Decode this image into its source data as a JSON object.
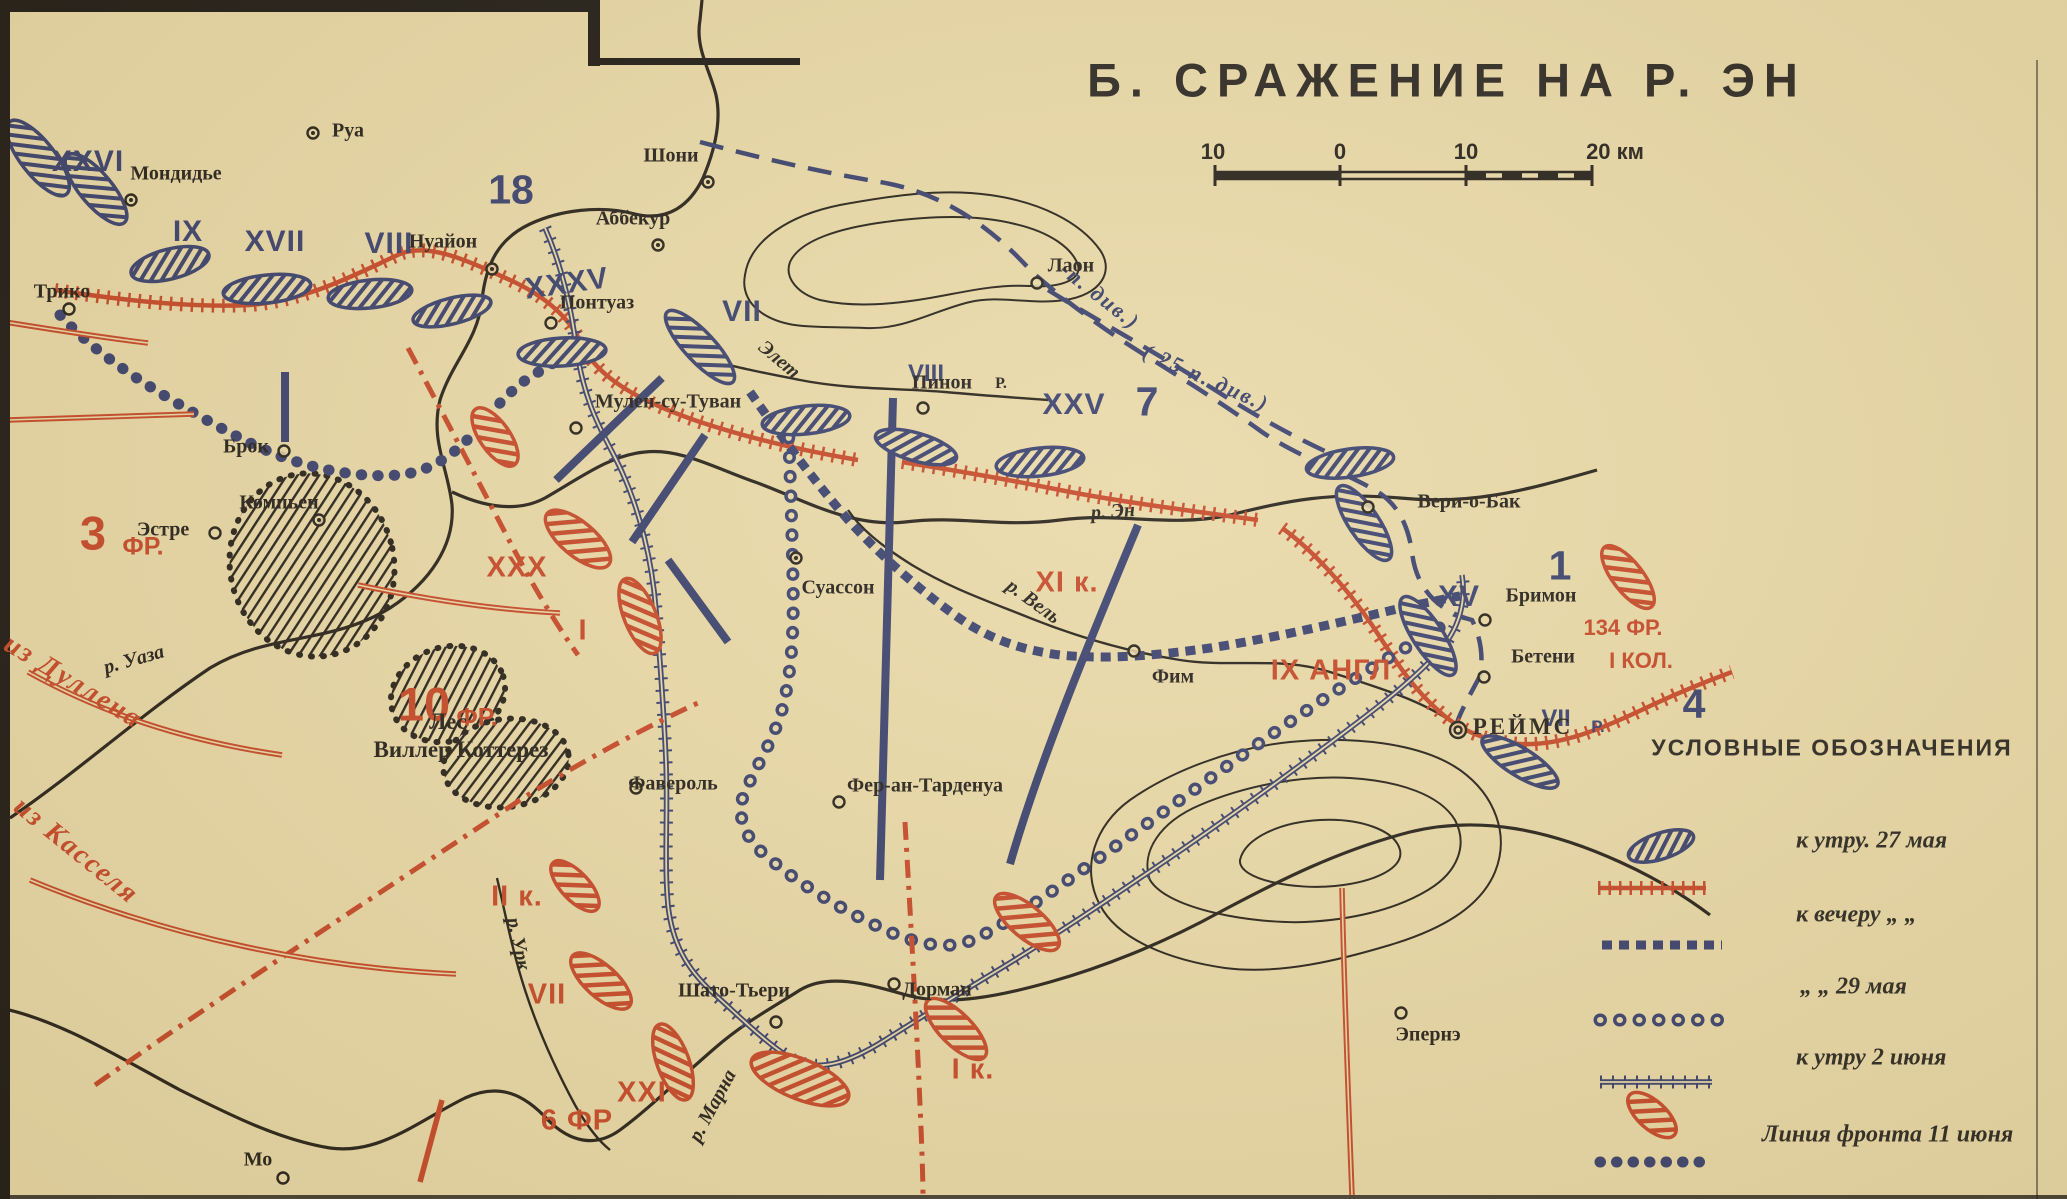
{
  "title": "Б. СРАЖЕНИЕ НА Р. ЭН",
  "colors": {
    "paper": "#e9d9a8",
    "blue": "#39406d",
    "red": "#c64828",
    "black": "#25201a"
  },
  "scale_bar": {
    "unit_note": "км",
    "tick_labels": [
      {
        "text": "10",
        "x": 1213
      },
      {
        "text": "0",
        "x": 1340
      },
      {
        "text": "10",
        "x": 1466
      },
      {
        "text": "20 км",
        "x": 1615
      }
    ]
  },
  "legend": {
    "number": "4",
    "title": "УСЛОВНЫЕ ОБОЗНАЧЕНИЯ",
    "items": [
      {
        "symbol": "blue-hatched-oval-icon",
        "label": "к утру. 27 мая",
        "x": 1796,
        "y": 841
      },
      {
        "symbol": "red-hatched-frontline-icon",
        "label": "к вечеру  „   „",
        "x": 1796,
        "y": 915
      },
      {
        "symbol": "blue-sawtooth-line-icon",
        "label": "„     „    29 мая",
        "x": 1800,
        "y": 987
      },
      {
        "symbol": "blue-circle-chain-icon",
        "label": "к утру 2 июня",
        "x": 1796,
        "y": 1058
      },
      {
        "symbol": "blue-double-tick-line-red-oval-teardrop-icon",
        "label": "Линия фронта 11 июня",
        "x": 1762,
        "y": 1135
      }
    ]
  },
  "towns": [
    {
      "name": "Руа",
      "x": 348,
      "y": 131,
      "cx": 313,
      "cy": 133,
      "t": "d"
    },
    {
      "name": "Мондидье",
      "x": 176,
      "y": 174,
      "cx": 131,
      "cy": 200,
      "t": "d"
    },
    {
      "name": "Трико",
      "x": 62,
      "y": 292,
      "cx": 69,
      "cy": 309,
      "t": "p"
    },
    {
      "name": "Нуайон",
      "x": 443,
      "y": 242,
      "cx": 492,
      "cy": 269,
      "t": "d"
    },
    {
      "name": "Шони",
      "x": 671,
      "y": 156,
      "cx": 708,
      "cy": 182,
      "t": "d"
    },
    {
      "name": "Аббекур",
      "x": 633,
      "y": 219,
      "cx": 658,
      "cy": 245,
      "t": "d"
    },
    {
      "name": "Понтуаз",
      "x": 597,
      "y": 303,
      "cx": 551,
      "cy": 323,
      "t": "p"
    },
    {
      "name": "Лаон",
      "x": 1071,
      "y": 266,
      "cx": 1037,
      "cy": 283,
      "t": "p"
    },
    {
      "name": "Мулен-су-Туван",
      "x": 668,
      "y": 402,
      "cx": 576,
      "cy": 428,
      "t": "p"
    },
    {
      "name": "Брок",
      "x": 246,
      "y": 447,
      "cx": 284,
      "cy": 451,
      "t": "p"
    },
    {
      "name": "Компьен",
      "x": 279,
      "y": 503,
      "cx": 319,
      "cy": 520,
      "t": "d"
    },
    {
      "name": "Эстре",
      "x": 163,
      "y": 530,
      "cx": 215,
      "cy": 533,
      "t": "p"
    },
    {
      "name": "Суассон",
      "x": 838,
      "y": 588,
      "cx": 796,
      "cy": 558,
      "t": "d"
    },
    {
      "name": "Пинон",
      "x": 942,
      "y": 383,
      "cx": 923,
      "cy": 408,
      "t": "p"
    },
    {
      "name": "Фавероль",
      "x": 673,
      "y": 784,
      "cx": 636,
      "cy": 788,
      "t": "p"
    },
    {
      "name": "Фер-ан-Тарденуа",
      "x": 925,
      "y": 786,
      "cx": 839,
      "cy": 802,
      "t": "p"
    },
    {
      "name": "Шато-Тьери",
      "x": 734,
      "y": 991,
      "cx": 776,
      "cy": 1022,
      "t": "p"
    },
    {
      "name": "Дорман",
      "x": 937,
      "y": 990,
      "cx": 894,
      "cy": 984,
      "t": "p"
    },
    {
      "name": "Мо",
      "x": 258,
      "y": 1160,
      "cx": 283,
      "cy": 1178,
      "t": "p"
    },
    {
      "name": "Эпернэ",
      "x": 1428,
      "y": 1035,
      "cx": 1401,
      "cy": 1013,
      "t": "p"
    },
    {
      "name": "Вери-о-Бак",
      "x": 1469,
      "y": 502,
      "cx": 1368,
      "cy": 507,
      "t": "p"
    },
    {
      "name": "Бримон",
      "x": 1541,
      "y": 596,
      "cx": 1485,
      "cy": 620,
      "t": "p"
    },
    {
      "name": "Бетени",
      "x": 1543,
      "y": 657,
      "cx": 1484,
      "cy": 677,
      "t": "p"
    },
    {
      "name": "РЕЙМС",
      "x": 1523,
      "y": 727,
      "cx": 1458,
      "cy": 730,
      "t": "D"
    },
    {
      "name": "Фим",
      "x": 1173,
      "y": 677,
      "cx": 1134,
      "cy": 651,
      "t": "p"
    }
  ],
  "labels": [
    {
      "t": "18",
      "x": 511,
      "y": 190,
      "s": "barmy"
    },
    {
      "t": "7",
      "x": 1147,
      "y": 402,
      "s": "barmy"
    },
    {
      "t": "1",
      "x": 1560,
      "y": 566,
      "s": "barmy"
    },
    {
      "t": "4",
      "x": 1694,
      "y": 704,
      "s": "barmy"
    },
    {
      "t": "XXVI",
      "x": 88,
      "y": 162,
      "s": "bcorps"
    },
    {
      "t": "IX",
      "x": 188,
      "y": 232,
      "s": "bcorps"
    },
    {
      "t": "XVII",
      "x": 275,
      "y": 242,
      "s": "bcorps"
    },
    {
      "t": "VIII",
      "x": 389,
      "y": 244,
      "s": "bcorps"
    },
    {
      "t": "XXXV",
      "x": 567,
      "y": 284,
      "s": "bcorps",
      "r": -8
    },
    {
      "t": "VII",
      "x": 742,
      "y": 312,
      "s": "bcorps"
    },
    {
      "t": "VIII",
      "x": 926,
      "y": 374,
      "s": "bcorps2"
    },
    {
      "t": "XXV",
      "x": 1074,
      "y": 405,
      "s": "bcorps"
    },
    {
      "t": "XV",
      "x": 1459,
      "y": 597,
      "s": "bcorps"
    },
    {
      "t": "VII",
      "x": 1556,
      "y": 719,
      "s": "bcorps2"
    },
    {
      "t": "Р.",
      "x": 1598,
      "y": 727,
      "s": "btiny"
    },
    {
      "t": "Р.",
      "x": 1001,
      "y": 384,
      "s": "ktiny"
    },
    {
      "t": "-п. див.)",
      "x": 1100,
      "y": 296,
      "s": "bnote",
      "r": 38
    },
    {
      "t": "( 25 п. див.)",
      "x": 1206,
      "y": 378,
      "s": "bnote",
      "r": 24
    },
    {
      "t": "3",
      "x": 93,
      "y": 533,
      "s": "rbig"
    },
    {
      "t": "ФР.",
      "x": 143,
      "y": 547,
      "s": "rsm"
    },
    {
      "t": "10",
      "x": 424,
      "y": 704,
      "s": "rbig"
    },
    {
      "t": "ФР.",
      "x": 477,
      "y": 718,
      "s": "rsm"
    },
    {
      "t": "XXX",
      "x": 517,
      "y": 568,
      "s": "rcorps"
    },
    {
      "t": "I",
      "x": 583,
      "y": 631,
      "s": "rcorps"
    },
    {
      "t": "II к.",
      "x": 517,
      "y": 897,
      "s": "rcorps"
    },
    {
      "t": "VII",
      "x": 547,
      "y": 995,
      "s": "rcorps"
    },
    {
      "t": "XXI",
      "x": 642,
      "y": 1093,
      "s": "rcorps"
    },
    {
      "t": "6 ФР",
      "x": 577,
      "y": 1121,
      "s": "rcorps"
    },
    {
      "t": "XI к.",
      "x": 1067,
      "y": 583,
      "s": "rcorps"
    },
    {
      "t": "IX АНГЛ",
      "x": 1331,
      "y": 671,
      "s": "rcorps"
    },
    {
      "t": "I к.",
      "x": 973,
      "y": 1070,
      "s": "rcorps"
    },
    {
      "t": "134 ФР.",
      "x": 1623,
      "y": 628,
      "s": "rcorps2"
    },
    {
      "t": "I КОЛ.",
      "x": 1641,
      "y": 661,
      "s": "rcorps2"
    },
    {
      "t": "из Дуллена",
      "x": 73,
      "y": 682,
      "s": "rnote",
      "r": 31
    },
    {
      "t": "из Касселя",
      "x": 76,
      "y": 851,
      "s": "rnote",
      "r": 39
    },
    {
      "t": "Лес",
      "x": 448,
      "y": 722,
      "s": "black"
    },
    {
      "t": "Виллер Коттерез",
      "x": 461,
      "y": 750,
      "s": "black"
    },
    {
      "t": "р. Уаза",
      "x": 134,
      "y": 660,
      "s": "river",
      "r": -16
    },
    {
      "t": "р. Эн",
      "x": 1113,
      "y": 512,
      "s": "river",
      "r": -4
    },
    {
      "t": "р. Вель",
      "x": 1033,
      "y": 602,
      "s": "river",
      "r": 36
    },
    {
      "t": "р. Марна",
      "x": 713,
      "y": 1106,
      "s": "river",
      "r": -62
    },
    {
      "t": "Элет",
      "x": 779,
      "y": 360,
      "s": "river",
      "r": 40
    },
    {
      "t": "р. Урк",
      "x": 518,
      "y": 944,
      "s": "river",
      "r": 78
    }
  ]
}
